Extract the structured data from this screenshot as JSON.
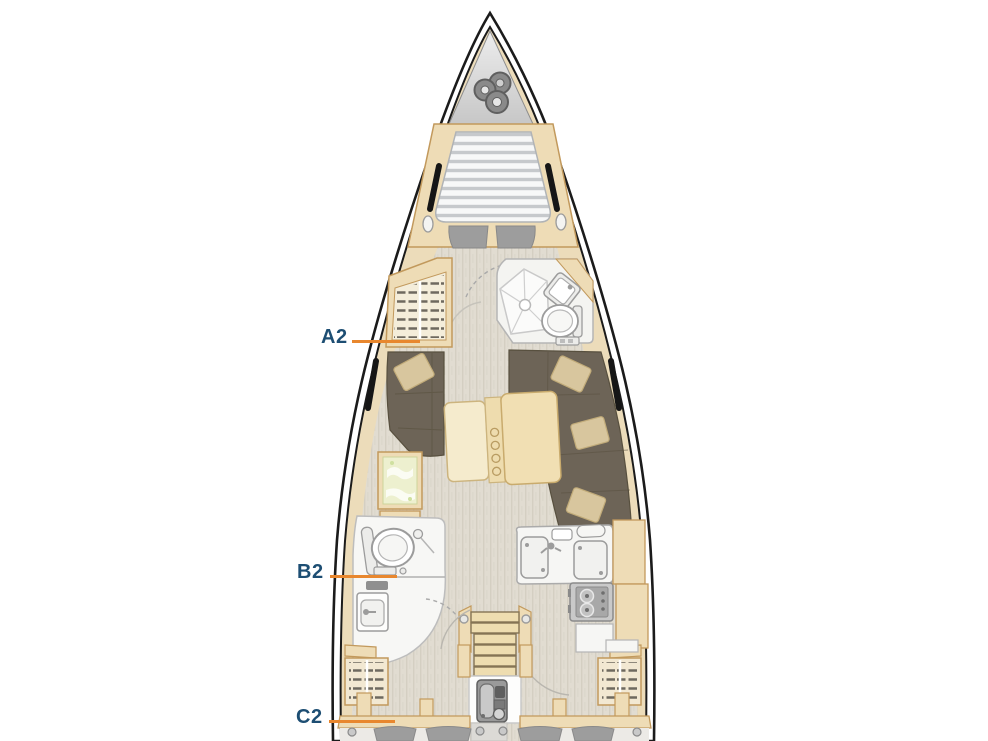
{
  "diagram": {
    "title": "sailboat-interior-floor-plan",
    "labels": {
      "a2": "A2",
      "b2": "B2",
      "c2": "C2"
    },
    "colors": {
      "label_text": "#1d4e73",
      "leader_line": "#e8872e",
      "hull_outline": "#1b1b1b",
      "wood_fill": "#ecdcba",
      "wood_border": "#c2995c",
      "floor": "#e1dcd1",
      "sofa": "#6d6457",
      "sofa_cushion_pillow": "#d8c69e",
      "berth_pillow_gray": "#9d9d9d",
      "fixture_fill": "#f6f6f4",
      "fixture_stroke": "#9c9c9c",
      "stove_gray": "#c9c9c9",
      "engine_gray": "#9a9a9a",
      "map_fill": "#edf0cf"
    },
    "icons": [
      "anchor-rope-coils-icon",
      "v-berth-mattress-icon",
      "shower-drain-icon",
      "sink-icon",
      "toilet-icon",
      "stove-burners-icon",
      "companionway-stairs-icon",
      "engine-icon",
      "chart-table-map-icon",
      "shelf-hatch-icon",
      "door-swing-arc-icon"
    ]
  }
}
